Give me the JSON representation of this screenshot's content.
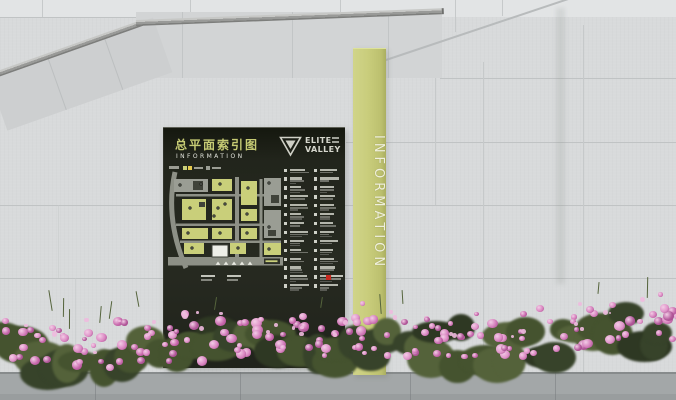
{
  "scene": {
    "setting": "outdoor wayfinding signage against granite tiled wall with azalea flower bed"
  },
  "wall": {
    "base_color": "#d8dadb",
    "upper_color": "#e2e4e5",
    "joint_color": "#c0c3c4"
  },
  "pavement": {
    "color": "#a3a7a8"
  },
  "sign": {
    "title": "总平面索引图",
    "subtitle": "INFORMATION",
    "logo": {
      "line1": "ELITE",
      "line2": "VALLEY",
      "mark": "nested-triangle"
    },
    "colors": {
      "board": "#23261e",
      "title_text": "#c6cb74",
      "subtitle_text": "#e3e4dc"
    },
    "legend": {
      "columns": 2,
      "rows_per_column": 14,
      "note": "micro text illegible in photo"
    },
    "footer": {
      "marker_color": "#c8291f",
      "groups": 2
    },
    "map": {
      "road_color": "#8d9086",
      "curve_road": "M7,1 C1,28 2,60 18,97",
      "roads": [
        [
          67,
          6,
          4,
          82
        ],
        [
          8,
          23,
          105,
          2.5
        ],
        [
          8,
          52.5,
          105,
          2.5
        ],
        [
          12,
          69.5,
          101,
          2.5
        ],
        [
          91.5,
          8,
          3,
          78
        ]
      ],
      "block_colors": {
        "yg": "#c9cf7a",
        "gray": "#9a9d94",
        "dark": "#40433a",
        "white": "#eeefe8"
      },
      "blocks": [
        [
          6,
          8,
          34,
          13,
          "gray"
        ],
        [
          25,
          10,
          10,
          9,
          "dark"
        ],
        [
          44,
          8,
          20,
          12,
          "yg"
        ],
        [
          73,
          10,
          16,
          24,
          "yg"
        ],
        [
          96,
          7,
          17,
          28,
          "gray"
        ],
        [
          103,
          24,
          8,
          8,
          "dark"
        ],
        [
          14,
          28,
          24,
          21,
          "yg"
        ],
        [
          44,
          28,
          20,
          21,
          "yg"
        ],
        [
          31,
          31,
          6,
          5,
          "dark"
        ],
        [
          73,
          38,
          16,
          12,
          "yg"
        ],
        [
          14,
          57,
          26,
          11,
          "yg"
        ],
        [
          44,
          57,
          20,
          11,
          "yg"
        ],
        [
          73,
          57,
          16,
          11,
          "yg"
        ],
        [
          96,
          39,
          17,
          28,
          "gray"
        ],
        [
          100,
          59,
          8,
          6,
          "dark"
        ],
        [
          16,
          72,
          20,
          11,
          "yg"
        ],
        [
          62,
          72,
          16,
          11,
          "yg"
        ],
        [
          96,
          72,
          17,
          12,
          "yg"
        ],
        [
          44,
          74,
          16,
          12,
          "white"
        ]
      ],
      "dots": [
        [
          12,
          14
        ],
        [
          33,
          13
        ],
        [
          52,
          13
        ],
        [
          80,
          17
        ],
        [
          101,
          12
        ],
        [
          22,
          37
        ],
        [
          50,
          37
        ],
        [
          79,
          43
        ],
        [
          20,
          62
        ],
        [
          52,
          62
        ],
        [
          79,
          62
        ],
        [
          101,
          56
        ],
        [
          24,
          77
        ],
        [
          70,
          77
        ],
        [
          101,
          78
        ],
        [
          57,
          33
        ],
        [
          46,
          45
        ]
      ],
      "bottom_band": [
        0,
        86,
        115,
        8.5
      ],
      "triangles": [
        50,
        58,
        66,
        74,
        82
      ],
      "triangle_y": 90.5,
      "road_label": {
        "x": 96,
        "y": 87.5,
        "w": 16,
        "h": 5.5,
        "bar_color": "#c9cf7a"
      }
    }
  },
  "pylon": {
    "text": "INFORMATION",
    "color": "#c9cd7c"
  },
  "flowers": {
    "petal_colors": [
      "#d37cba",
      "#c868ac",
      "#e094c9",
      "#b2589a",
      "#da86c1"
    ],
    "highlight_color": "#eebade",
    "foliage_colors": [
      "#45532f",
      "#37432a",
      "#54623a",
      "#2e3823"
    ],
    "seed": 7,
    "foliage_count": 55,
    "bloom_count": 160,
    "highlight_count": 30,
    "stem_count": 12
  }
}
